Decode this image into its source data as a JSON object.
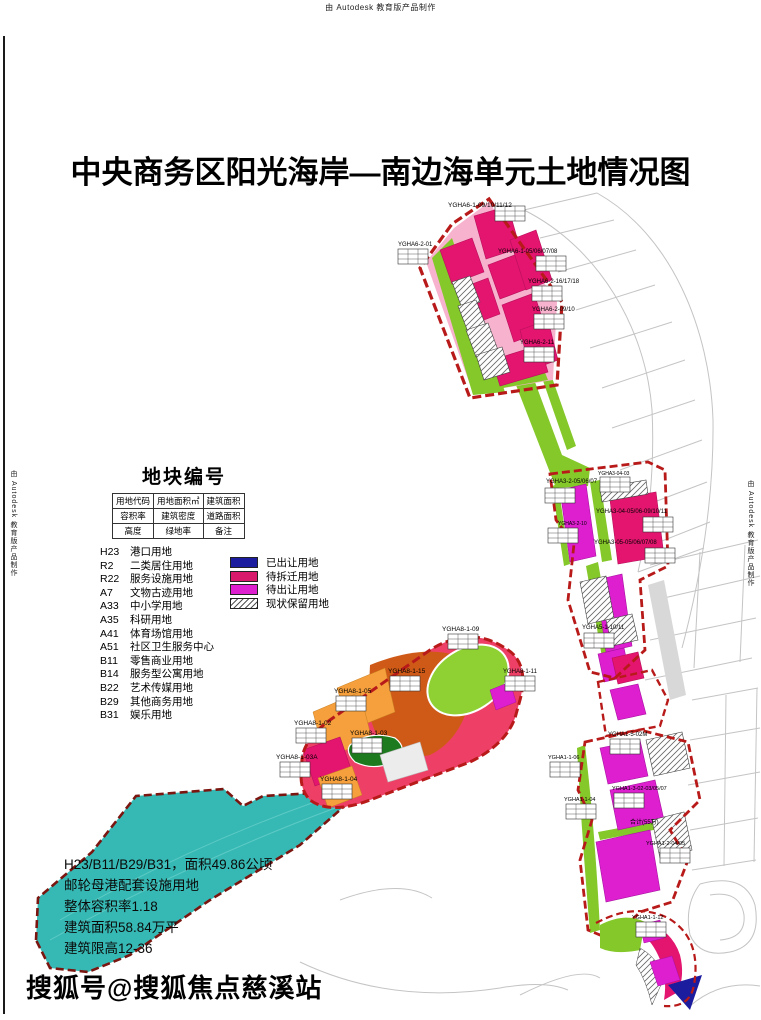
{
  "credit": "由 Autodesk 教育版产品制作",
  "title": "中央商务区阳光海岸—南边海单元土地情况图",
  "legend": {
    "heading": "地块编号",
    "key_table": {
      "rows": [
        [
          "用地代码",
          "用地面积㎡",
          "建筑面积"
        ],
        [
          "容积率",
          "建筑密度",
          "道路面积"
        ],
        [
          "高度",
          "绿地率",
          "备注"
        ]
      ]
    },
    "landuse_codes": [
      {
        "code": "H23",
        "label": "港口用地"
      },
      {
        "code": "R2",
        "label": "二类居住用地"
      },
      {
        "code": "R22",
        "label": "服务设施用地"
      },
      {
        "code": "A7",
        "label": "文物古迹用地"
      },
      {
        "code": "A33",
        "label": "中小学用地"
      },
      {
        "code": "A35",
        "label": "科研用地"
      },
      {
        "code": "A41",
        "label": "体育场馆用地"
      },
      {
        "code": "A51",
        "label": "社区卫生服务中心"
      },
      {
        "code": "B11",
        "label": "零售商业用地"
      },
      {
        "code": "B14",
        "label": "服务型公寓用地"
      },
      {
        "code": "B22",
        "label": "艺术传媒用地"
      },
      {
        "code": "B29",
        "label": "其他商务用地"
      },
      {
        "code": "B31",
        "label": "娱乐用地"
      }
    ],
    "status_items": [
      {
        "label": "已出让用地",
        "color": "#1c1c9e",
        "pattern": "solid"
      },
      {
        "label": "待拆迁用地",
        "color": "#d9196b",
        "pattern": "solid"
      },
      {
        "label": "待出让用地",
        "color": "#dd1fd0",
        "pattern": "solid"
      },
      {
        "label": "现状保留用地",
        "color": "#ffffff",
        "pattern": "hatch"
      }
    ]
  },
  "annotation": {
    "lines": [
      "H23/B11/B29/B31，面积49.86公顷",
      "邮轮母港配套设施用地",
      "整体容积率1.18",
      "建筑面积58.84万平",
      "建筑限高12-36"
    ]
  },
  "map_labels": {
    "n1": "YGHA6-1-09/10/11/12",
    "n2": "YGHA6-2-01",
    "n3": "YGHA6-1-05/06/07/08",
    "n4": "YGHA6-2-16/17/18",
    "n5": "YGHA6-2-09/10",
    "n6": "YGHA6-2-11",
    "m1": "YGHA3-2-05/06/07",
    "m2": "YGHA3-04-03",
    "m3": "YGHA3-04-05/06-09/10/11",
    "m4": "YGHA3-2-10",
    "m5": "YGHA3-05-05/06/07/08",
    "m6": "YGHA5-1-10/11",
    "c1": "YGHA8-1-09",
    "c2": "YGHA8-1-15",
    "c3": "YGHA8-1-05",
    "c4": "YGHA8-1-02",
    "c5": "YGHA8-1-03",
    "c6": "YGHA8-1-03A",
    "c7": "YGHA8-1-04",
    "c8": "YGHA8-1-11",
    "s1": "YGHA1-5-02M",
    "s2": "YGHA1-1-04",
    "s3": "YGHA1-3-02-03/05/07",
    "s4": "合计(55万)",
    "s5": "YGHA1-2-04/05",
    "s6": "YGHA1-1-06",
    "s7": "YGHA1-1-12"
  },
  "watermark": "搜狐号@搜狐焦点慈溪站",
  "colors": {
    "sold": "#1c1c9e",
    "to_demolish": "#d9196b",
    "to_transfer": "#dd1fd0",
    "green_space": "#85c829",
    "orange_parcel": "#f5a03c",
    "rust_parcel": "#cf5a17",
    "dark_green_parcel": "#1e7a1e",
    "water_teal": "#36b9b4",
    "boundary_red": "#b81a1a"
  }
}
